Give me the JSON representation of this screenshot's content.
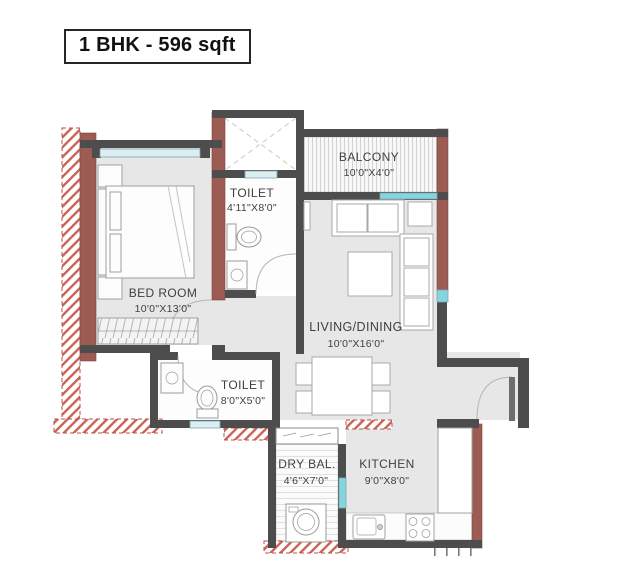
{
  "title": "1 BHK - 596 sqft",
  "palette": {
    "exterior_brick_wall": "#9c5b53",
    "interior_wall": "#4d4d4d",
    "floor": "#e7e7e7",
    "window_pale": "#dceef1",
    "window_bright": "#86d4de",
    "plinth_hatch_red": "#c4564a",
    "furniture_line": "#a0a0a0",
    "label_text": "#3f3f3f"
  },
  "rooms": [
    {
      "id": "bedroom",
      "name": "BED ROOM",
      "dims": "10'0\"X13'0\""
    },
    {
      "id": "toilet_attached",
      "name": "TOILET",
      "dims": "4'11\"X8'0\""
    },
    {
      "id": "balcony",
      "name": "BALCONY",
      "dims": "10'0\"X4'0\""
    },
    {
      "id": "living_dining",
      "name": "LIVING/DINING",
      "dims": "10'0\"X16'0\""
    },
    {
      "id": "toilet_common",
      "name": "TOILET",
      "dims": "8'0\"X5'0\""
    },
    {
      "id": "dry_balcony",
      "name": "DRY BAL.",
      "dims": "4'6\"X7'0\""
    },
    {
      "id": "kitchen",
      "name": "KITCHEN",
      "dims": "9'0\"X8'0\""
    }
  ]
}
